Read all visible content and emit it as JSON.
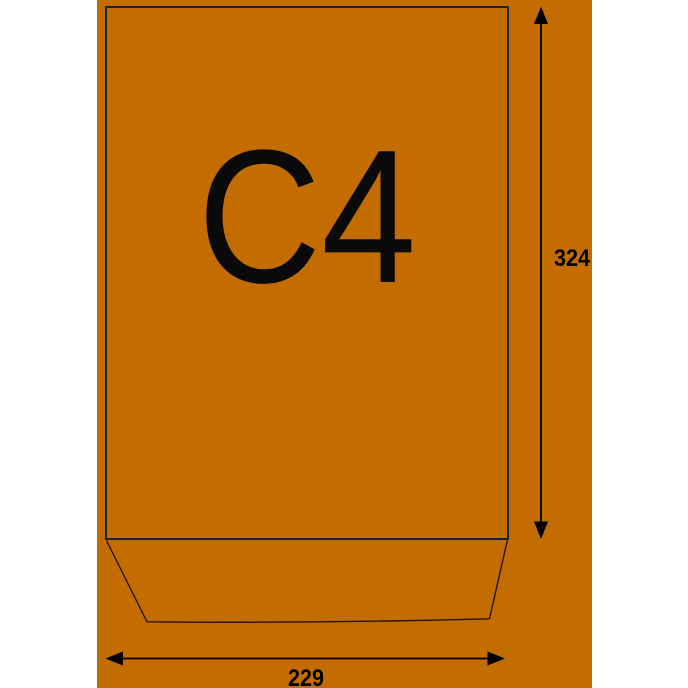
{
  "diagram": {
    "envelope_label": "C4",
    "height_dimension": "324",
    "width_dimension": "229"
  },
  "icons": {
    "height_arrow": "double-headed-vertical-arrow",
    "width_arrow": "double-headed-horizontal-arrow"
  },
  "colors": {
    "canvas_background": "#FFFFFF",
    "envelope_fill": "#C36D00",
    "envelope_border": "#112442",
    "flap_line": "#2A1200",
    "dimension_color": "#000000",
    "label_color": "#0A0A0A"
  }
}
